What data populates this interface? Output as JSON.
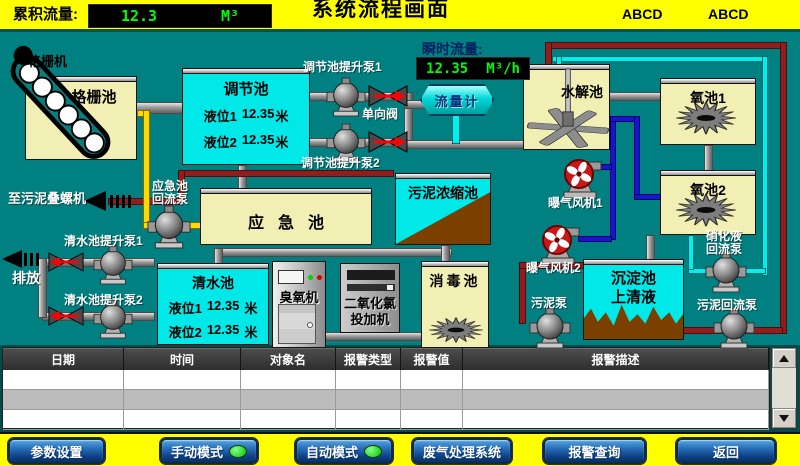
{
  "header": {
    "cumulative_flow_label": "累积流量:",
    "cumulative_flow_value": "12.3",
    "cumulative_flow_unit": "M³",
    "title": "系统流程画面",
    "tag1": "ABCD",
    "tag2": "ABCD"
  },
  "flow": {
    "instant_label": "瞬时流量:",
    "instant_value": "12.35",
    "instant_unit": "M³/h",
    "meter_label": "流量计"
  },
  "tanks": {
    "grid_pool": "格栅池",
    "regulation_pool": "调节池",
    "hydrolysis_pool": "水解池",
    "oxygen_pool_1": "氧池1",
    "oxygen_pool_2": "氧池2",
    "emergency_pool": "应急池",
    "sludge_thickening_pool": "污泥浓缩池",
    "clear_water_pool": "清水池",
    "disinfection_pool": "消毒池",
    "sedimentation_pool": "沉淀池\n上清液"
  },
  "levels": {
    "regulation": {
      "l1_label": "液位1",
      "l1_value": "12.35",
      "l1_unit": "米",
      "l2_label": "液位2",
      "l2_value": "12.35",
      "l2_unit": "米"
    },
    "clear_water": {
      "l1_label": "液位1",
      "l1_value": "12.35",
      "l1_unit": "米",
      "l2_label": "液位2",
      "l2_value": "12.35",
      "l2_unit": "米"
    }
  },
  "equipment": {
    "grid_machine": "格栅机",
    "regulation_pump_1": "调节池提升泵1",
    "regulation_pump_2": "调节池提升泵2",
    "check_valve": "单向阀",
    "to_sludge_screw": "至污泥叠螺机",
    "emergency_return_pump": "应急池\n回流泵",
    "aeration_fan_1": "曝气风机1",
    "aeration_fan_2": "曝气风机2",
    "clear_water_pump_1": "清水池提升泵1",
    "clear_water_pump_2": "清水池提升泵2",
    "discharge": "排放",
    "ozone_machine": "臭氧机",
    "chlorine_dioxide_doser": "二氧化氯\n投加机",
    "sludge_pump": "污泥泵",
    "nitrification_return_pump": "硝化液\n回流泵",
    "sludge_return_pump": "污泥回流泵"
  },
  "alarm_table": {
    "columns": [
      "日期",
      "时间",
      "对象名",
      "报警类型",
      "报警值",
      "报警描述"
    ],
    "rows": [
      [
        "",
        "",
        "",
        "",
        "",
        ""
      ],
      [
        "",
        "",
        "",
        "",
        "",
        ""
      ],
      [
        "",
        "",
        "",
        "",
        "",
        ""
      ]
    ]
  },
  "footer": {
    "buttons": [
      {
        "label": "参数设置",
        "led": false
      },
      {
        "label": "手动模式",
        "led": true
      },
      {
        "label": "自动模式",
        "led": true
      },
      {
        "label": "废气处理系统",
        "led": false
      },
      {
        "label": "报警查询",
        "led": false
      },
      {
        "label": "返回",
        "led": false
      }
    ]
  },
  "colors": {
    "background_teal": "#008080",
    "header_yellow": "#ffff00",
    "digital_green": "#00ff00",
    "tank_yellow": "#f2efb4",
    "tank_cyan": "#00e8e8",
    "sludge_brown": "#7b3f00",
    "pipe_maroon": "#8f1f1f",
    "pipe_blue": "#1414d2",
    "pipe_cyan": "#00f0f0",
    "pipe_yellow": "#ffd900",
    "button_blue": "#1356a0",
    "led_green": "#00dd00"
  }
}
